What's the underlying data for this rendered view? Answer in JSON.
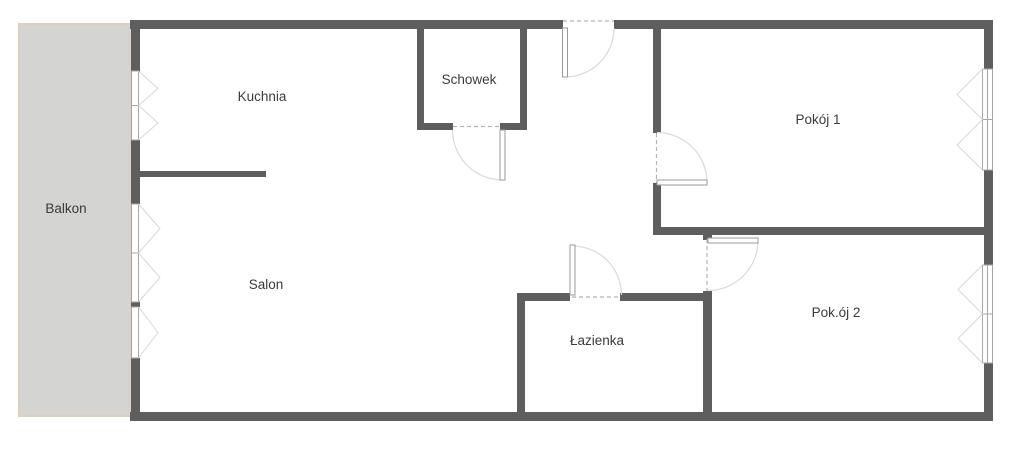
{
  "labels": {
    "balkon": "Balkon",
    "kuchnia": "Kuchnia",
    "schowek": "Schowek",
    "pokoj1": "Pokój 1",
    "salon": "Salon",
    "lazienka": "Łazienka",
    "pokoj2": "Pok.ój 2"
  },
  "colors": {
    "bg": "#ffffff",
    "wall": "#5e5e5e",
    "balcony_fill": "#d4d4d2",
    "balcony_border": "#d9d0c0",
    "frame_stroke": "#a6a6a6",
    "leaf_stroke": "#9a9a9a",
    "arc_stroke": "#dadada",
    "dash_stroke": "#b5b5b5",
    "v_stroke": "#d8d8d8",
    "label_text": "#3b3b3b"
  }
}
